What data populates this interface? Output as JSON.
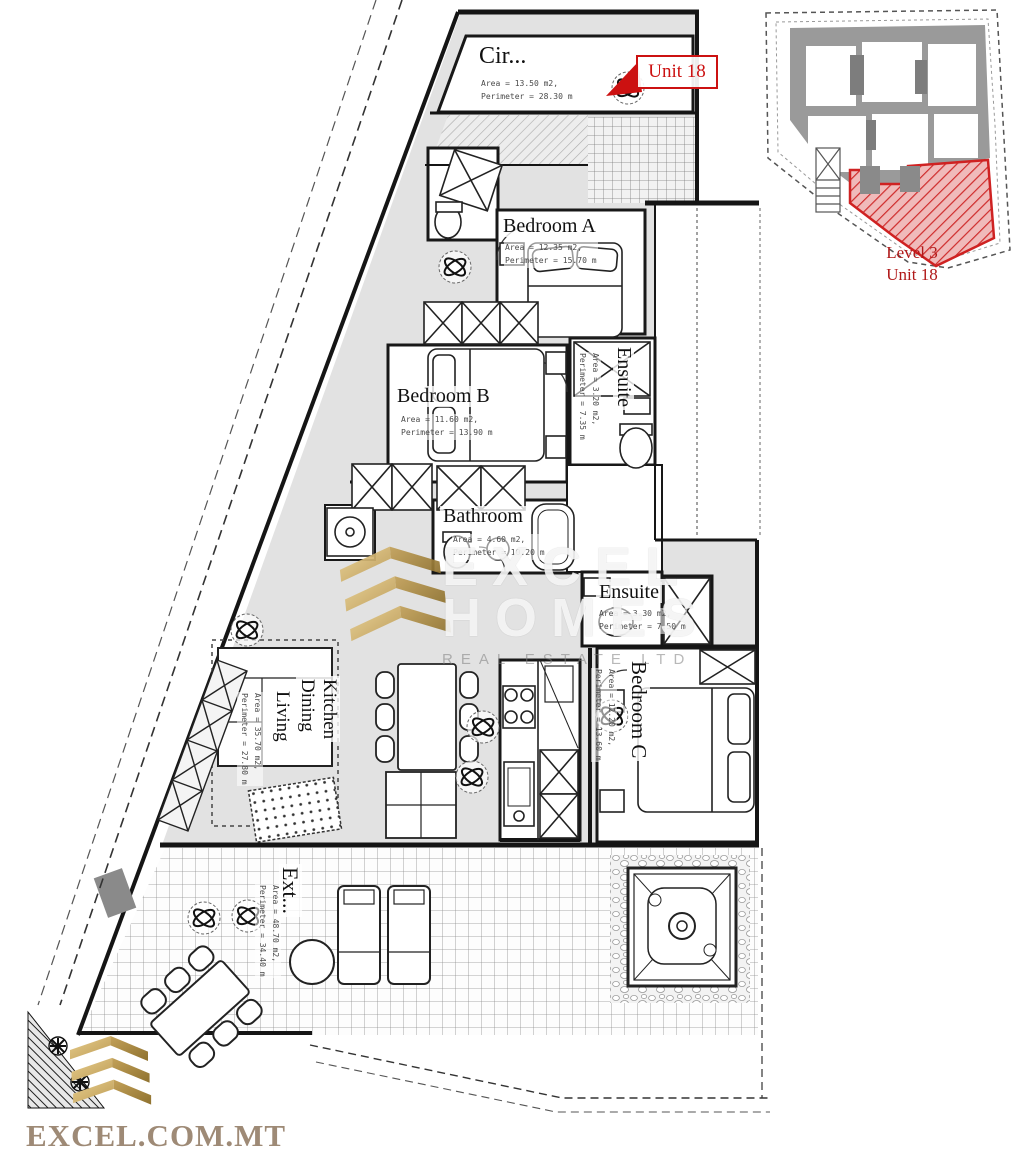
{
  "title": "Apartment floor plan - Level 3 Unit 18",
  "unit_tag": {
    "label": "Unit 18"
  },
  "minimap": {
    "caption_line1": "Level 3",
    "caption_line2": "Unit 18"
  },
  "rooms": {
    "circulation": {
      "name": "Cir...",
      "area": "Area = 13.50 m2,",
      "perimeter": "Perimeter = 28.30 m"
    },
    "bedroom_a": {
      "name": "Bedroom A",
      "area": "Area = 12.35 m2,",
      "perimeter": "Perimeter = 15.70 m"
    },
    "bedroom_b": {
      "name": "Bedroom B",
      "area": "Area = 11.60 m2,",
      "perimeter": "Perimeter = 13.90 m"
    },
    "ensuite_a": {
      "name": "Ensuite",
      "area": "Area = 3.20 m2,",
      "perimeter": "Perimeter = 7.35 m"
    },
    "bathroom": {
      "name": "Bathroom",
      "area": "Area = 4.60 m2,",
      "perimeter": "Perimeter = 10.20 m"
    },
    "ensuite_c": {
      "name": "Ensuite",
      "area": "Area = 3.30 m2,",
      "perimeter": "Perimeter = 7.50 m"
    },
    "bedroom_c": {
      "name": "Bedroom C",
      "area": "Area = 12.20 m2,",
      "perimeter": "Perimeter = 13.60 m"
    },
    "kitchen_dining": {
      "name_line1": "Kitchen",
      "name_line2": "Dining"
    },
    "living": {
      "name": "Living",
      "area": "Area = 35.70 m2,",
      "perimeter": "Perimeter = 27.80 m"
    },
    "exterior": {
      "name": "Ext...",
      "area": "Area = 48.70 m2,",
      "perimeter": "Perimeter = 34.40 m"
    }
  },
  "watermark": {
    "line1": "EXCEL",
    "line2": "HOMES",
    "line3": "REAL ESTATE LTD"
  },
  "branding": {
    "website": "EXCEL.COM.MT"
  },
  "colors": {
    "unit_red": "#cc1111",
    "caption_red": "#b01818",
    "gold": "#c8a653",
    "taupe": "#9e8a76"
  }
}
